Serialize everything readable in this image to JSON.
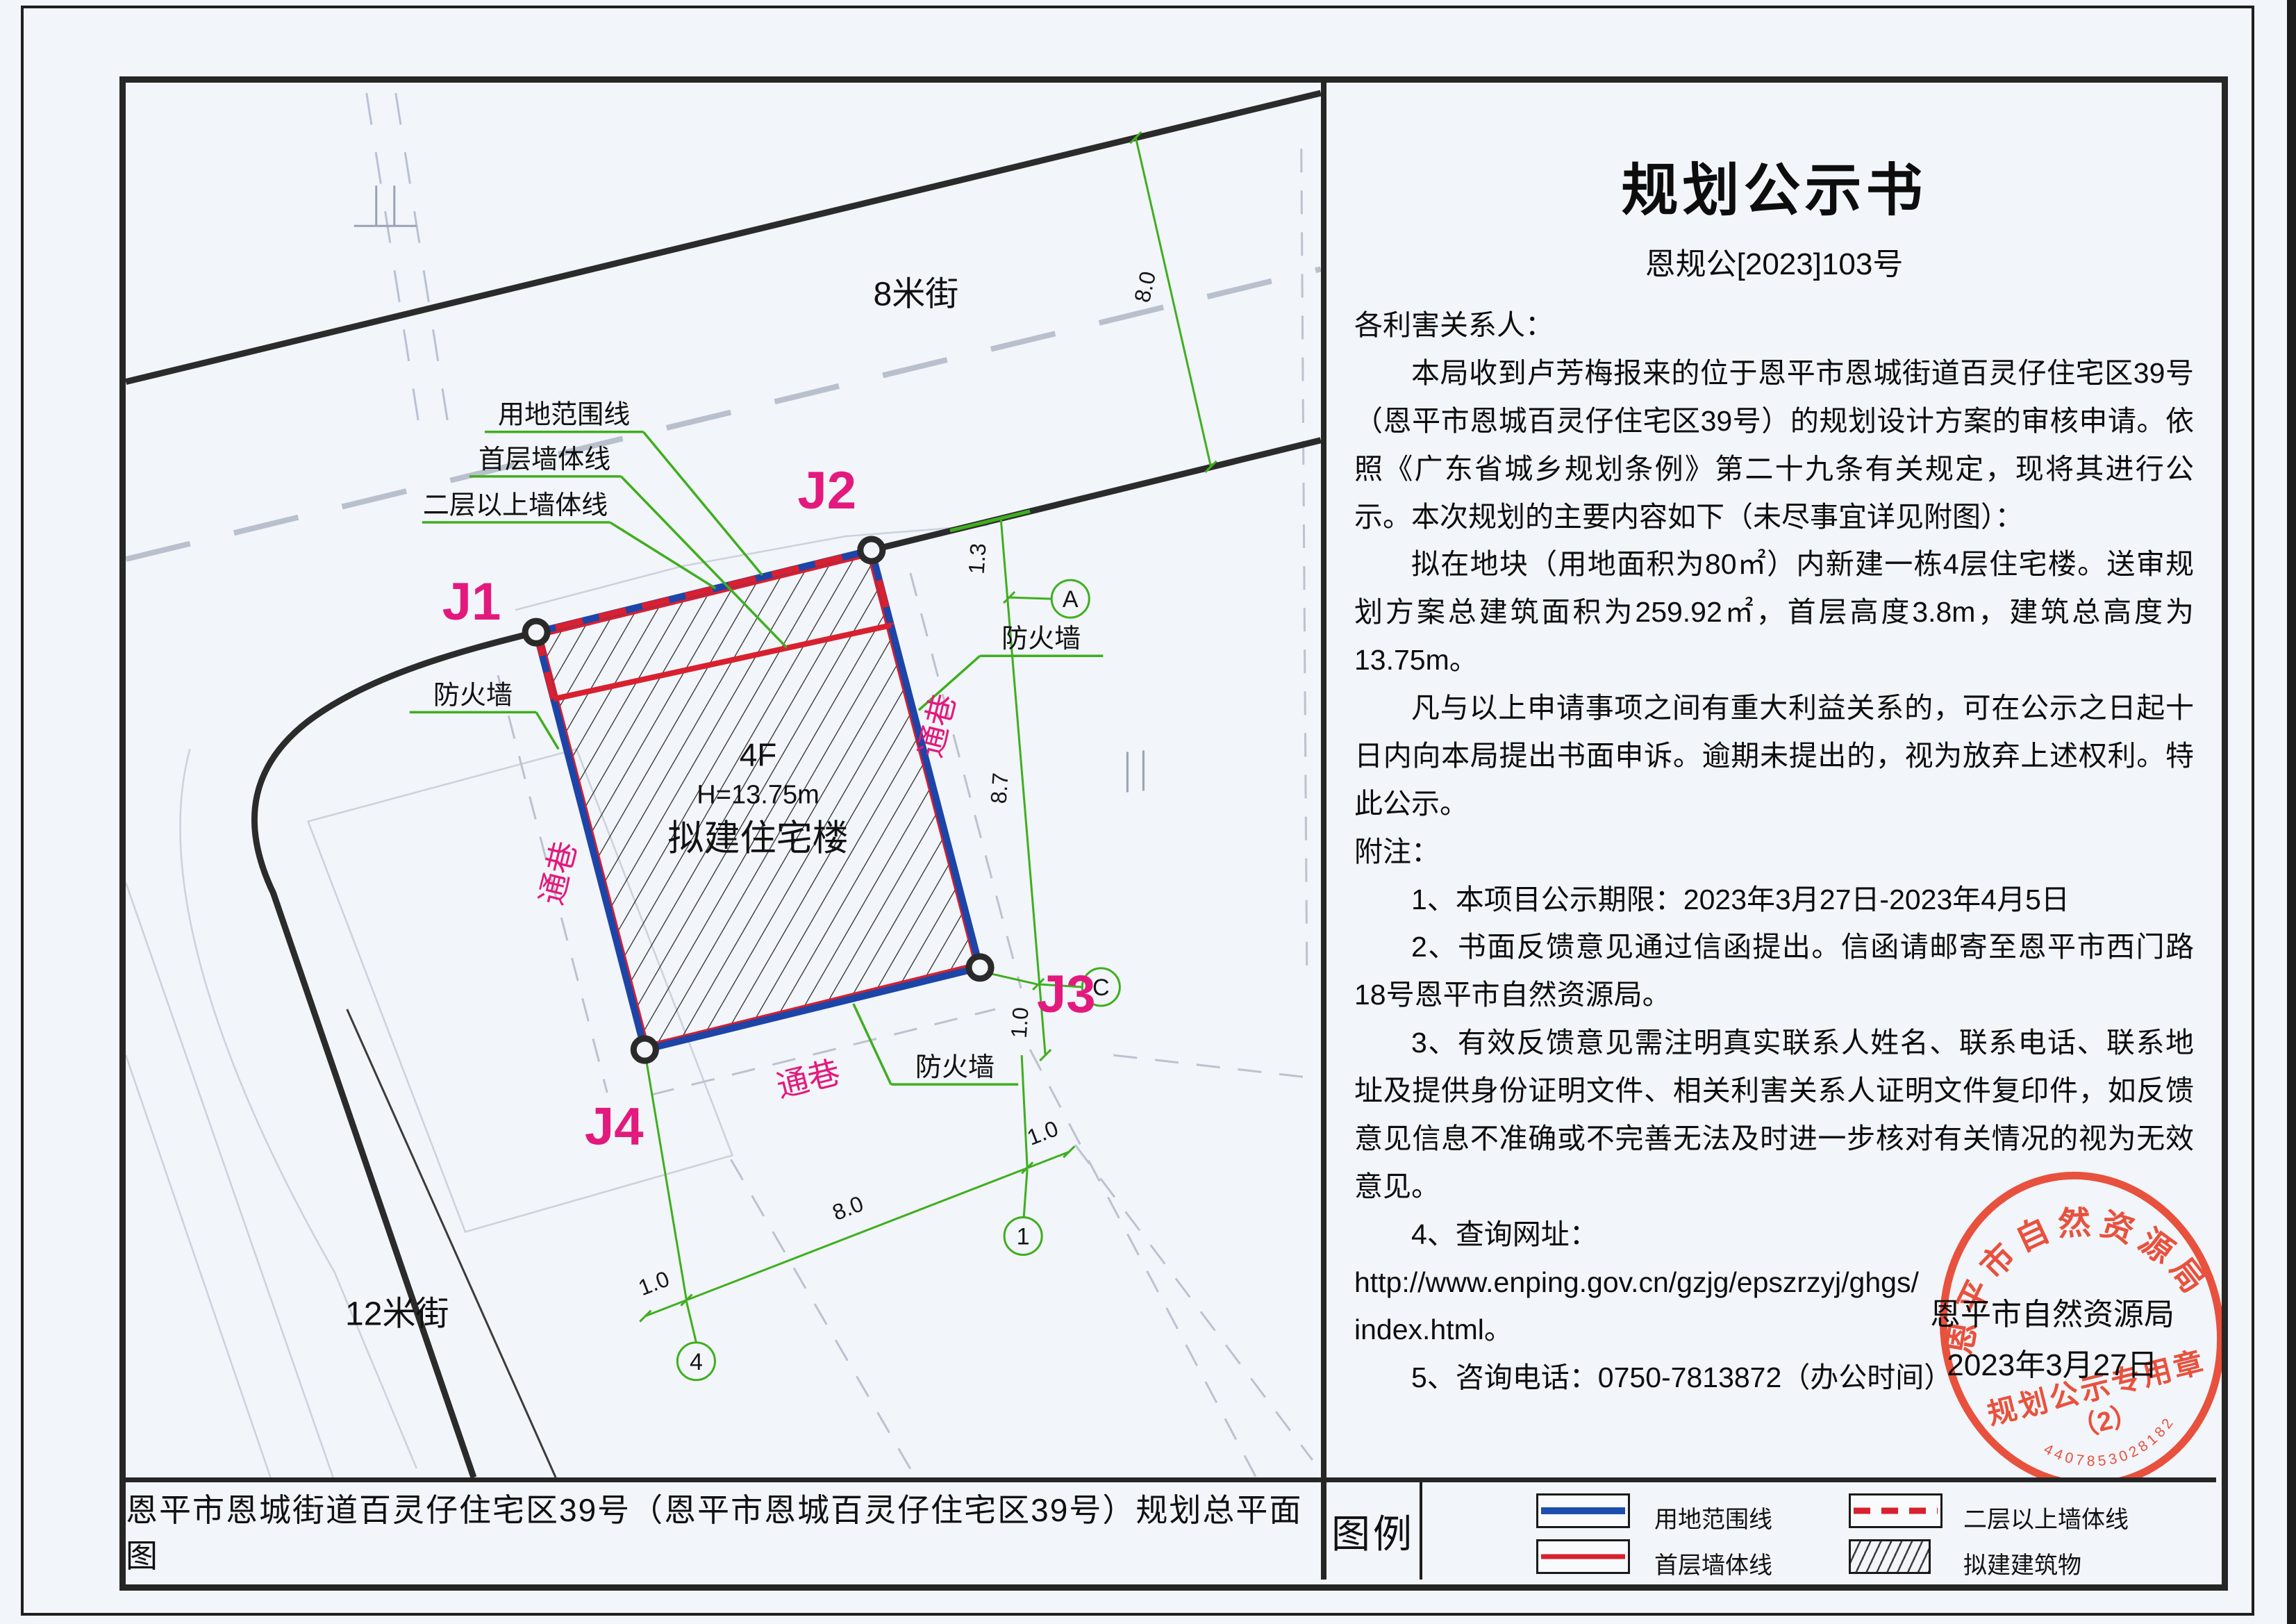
{
  "notice": {
    "title": "规划公示书",
    "doc_no": "恩规公[2023]103号",
    "paragraphs": {
      "p0": "各利害关系人：",
      "p1": "本局收到卢芳梅报来的位于恩平市恩城街道百灵仔住宅区39号（恩平市恩城百灵仔住宅区39号）的规划设计方案的审核申请。依照《广东省城乡规划条例》第二十九条有关规定，现将其进行公示。本次规划的主要内容如下（未尽事宜详见附图）：",
      "p2": "拟在地块（用地面积为80㎡）内新建一栋4层住宅楼。送审规划方案总建筑面积为259.92㎡，首层高度3.8m，建筑总高度为13.75m。",
      "p3": "凡与以上申请事项之间有重大利益关系的，可在公示之日起十日内向本局提出书面申诉。逾期未提出的，视为放弃上述权利。特此公示。",
      "p4": "附注：",
      "p5": "1、本项目公示期限：2023年3月27日-2023年4月5日",
      "p6": "2、书面反馈意见通过信函提出。信函请邮寄至恩平市西门路18号恩平市自然资源局。",
      "p7": "3、有效反馈意见需注明真实联系人姓名、联系电话、联系地址及提供身份证明文件、相关利害关系人证明文件复印件，如反馈意见信息不准确或不完善无法及时进一步核对有关情况的视为无效意见。",
      "p8": "4、查询网址：",
      "p9": "http://www.enping.gov.cn/gzjg/epszrzyj/ghgs/",
      "p10": "index.html。",
      "p11": "5、咨询电话：0750-7813872（办公时间）"
    }
  },
  "signature": {
    "org": "恩平市自然资源局",
    "date": "2023年3月27日"
  },
  "stamp": {
    "ring_text": "恩平市自然资源局",
    "center_line1": "规划公示专用章",
    "center_line2": "（2）",
    "serial": "4407853028182",
    "color": "#e8442e"
  },
  "caption": "恩平市恩城街道百灵仔住宅区39号（恩平市恩城百灵仔住宅区39号）规划总平面图",
  "legend": {
    "title": "图例",
    "items": {
      "boundary": "用地范围线",
      "ground_wall": "首层墙体线",
      "upper_wall": "二层以上墙体线",
      "proposed_building": "拟建建筑物"
    }
  },
  "map": {
    "streets": {
      "north": "8米街",
      "west": "12米街"
    },
    "corner_labels": {
      "j1": "J1",
      "j2": "J2",
      "j3": "J3",
      "j4": "J4"
    },
    "building": {
      "floors": "4F",
      "height": "H=13.75m",
      "name": "拟建住宅楼"
    },
    "line_labels": {
      "boundary": "用地范围线",
      "ground_wall": "首层墙体线",
      "upper_wall": "二层以上墙体线"
    },
    "alley_label": "通巷",
    "firewall_label": "防火墙",
    "dims": {
      "street_width": "8.0",
      "east_top": "1.3",
      "east_mid": "8.7",
      "east_bottom": "1.0",
      "south_left": "1.0",
      "south_mid": "8.0",
      "south_right": "1.0"
    },
    "axes": {
      "a": "A",
      "c": "C",
      "n1": "1",
      "n4": "4"
    },
    "colors": {
      "boundary_blue": "#1d45a8",
      "wall_red": "#d8202f",
      "annotation_green": "#3fae1f",
      "label_magenta": "#e3197d"
    }
  }
}
